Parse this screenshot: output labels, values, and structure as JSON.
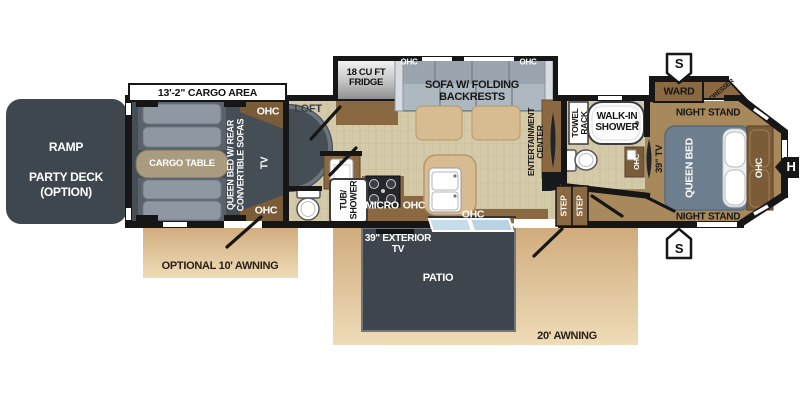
{
  "title": "Fifth wheel toy hauler floor plan",
  "colors": {
    "wall": "#161616",
    "floor_tile": "#d4c9a8",
    "cargo_floor": "#454d55",
    "ramp_deck": "#3e464e",
    "patio_deck": "#3e454d",
    "cabinet_brown": "#8a6942",
    "cabinet_dark_brown": "#7a5c38",
    "bedroom_floor": "#a8895c",
    "sofa_gray": "#9aa5af",
    "bed_gray": "#6d7e8e",
    "island_tan": "#d6bc90",
    "awning_tan": "#ddbd92",
    "glass_blue": "#c7dcea"
  },
  "labels": {
    "cargo_area": "13'-2\" CARGO AREA",
    "ramp": "RAMP\n\nPARTY DECK\n(OPTION)",
    "cargo_table": "CARGO TABLE",
    "convertible": "QUEEN BED W/ REAR\nCONVERTIBLE SOFAS",
    "ohc_cargo_top": "OHC",
    "ohc_cargo_bottom": "OHC",
    "tv_cargo": "TV",
    "loft": "LOFT",
    "fridge": "18 CU FT\nFRIDGE",
    "ohc_fridge_top": "OHC",
    "sofa": "SOFA W/ FOLDING\nBACKRESTS",
    "ohc_sofa_top": "OHC",
    "tub_shower": "TUB/\nSHOWER",
    "micro": "MICRO",
    "ohc_kitchen": "OHC",
    "ohc_kitchen_lower": "OHC",
    "ent_center": "ENTERTAINMENT\nCENTER",
    "towel_rack": "TOWEL\nRACK",
    "walkin_shower": "WALK-IN\nSHOWER",
    "ohc_bath": "OHC",
    "tv_bedroom": "39\" TV",
    "step_a": "STEP",
    "step_b": "STEP",
    "ward": "WARD",
    "dresser": "DRESSER",
    "night_stand_top": "NIGHT STAND",
    "night_stand_bottom": "NIGHT STAND",
    "queen_bed": "QUEEN BED",
    "ohc_bed": "OHC",
    "speaker_top": "S",
    "speaker_bottom": "S",
    "hitch": "H",
    "optional_awning": "OPTIONAL 10' AWNING",
    "awning_20": "20' AWNING",
    "patio": "PATIO",
    "exterior_tv": "39\" EXTERIOR\nTV"
  }
}
